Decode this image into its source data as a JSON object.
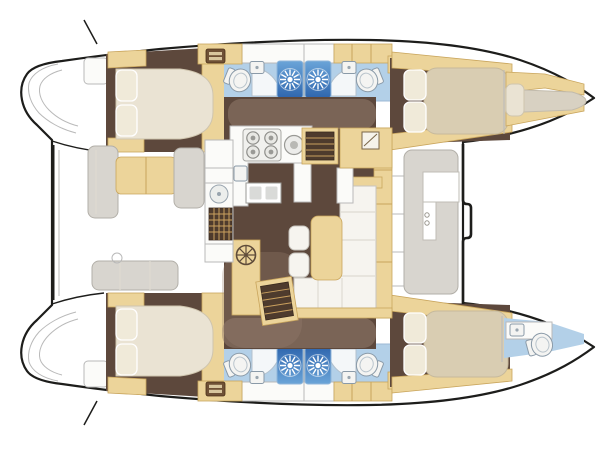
{
  "diagram": {
    "type": "catamaran-deck-plan",
    "orientation": "bow-right",
    "hulls": {
      "top": [
        "stern-platform",
        "aft-double-cabin",
        "bathroom-with-shower",
        "bathroom-with-shower",
        "forward-double-cabin",
        "forepeak-berth"
      ],
      "bottom": [
        "stern-platform",
        "aft-double-cabin",
        "bathroom-with-shower",
        "bathroom-with-shower",
        "forward-double-cabin",
        "forepeak-head"
      ]
    },
    "bridge_deck": [
      "aft-cockpit-seats",
      "cockpit-sunbed",
      "wet-bar-counter",
      "deck-grate",
      "galley-with-stove",
      "double-sink",
      "saloon-sofa",
      "saloon-table",
      "saloon-stools",
      "stairs-to-starboard-hull",
      "stairs-to-port-hull",
      "mast-post-cabinet",
      "forward-cockpit-seat"
    ],
    "counts": {
      "double_cabins": 4,
      "shower_stalls": 4,
      "toilets": 5,
      "washbasins": 8,
      "stove_burners": 5,
      "companionway_stairs": 2,
      "saloon_stools": 2
    },
    "icons": [
      "shower-starburst-icon",
      "toilet-icon",
      "washbasin-icon",
      "stove-burner-icon",
      "spoked-wheel-icon",
      "vent-grille-icon",
      "deck-grate-icon"
    ]
  },
  "palette": {
    "background": "#ffffff",
    "outline": "#1d1d1b",
    "line": "#b9b9b9",
    "tan": "#ecd49a",
    "tan_edge": "#c9a55c",
    "wood": "#5d483c",
    "overlay": "#97806f",
    "cream": "#eae3d3",
    "cream_edge": "#cfc5ae",
    "pillow": "#f0ead9",
    "mat_tan": "#d9cdb2",
    "berth": "#d8d1c2",
    "bath": "#b3d0e8",
    "shower_top": "#6aa4d8",
    "shower_bottom": "#2f66ae",
    "fixture": "#f4f4f2",
    "fixture_edge": "#8a9aa8",
    "seat": "#d8d5cf",
    "seat_edge": "#b2afa8",
    "sofa": "#f6f4ef",
    "sofa_edge": "#c8c5be",
    "counter": "#fbfbf9",
    "grate": "#4e3b2d",
    "grate_line": "#caa05e",
    "steel": "#d9dad8"
  }
}
